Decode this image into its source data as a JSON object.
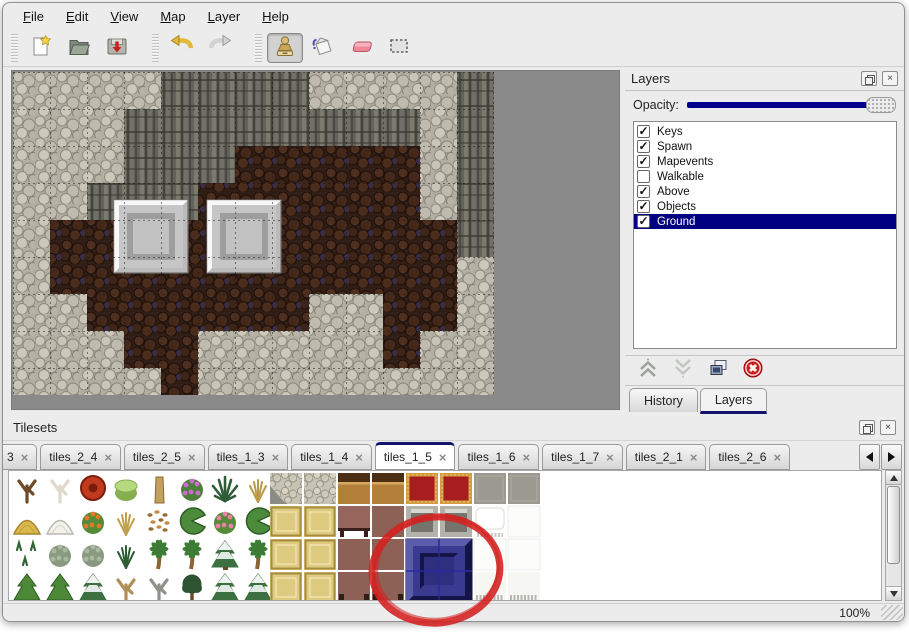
{
  "menu": {
    "items": [
      "File",
      "Edit",
      "View",
      "Map",
      "Layer",
      "Help"
    ]
  },
  "toolbar": {
    "groups": [
      {
        "buttons": [
          {
            "name": "new-file",
            "icon": "new"
          },
          {
            "name": "open-file",
            "icon": "open"
          },
          {
            "name": "save-file",
            "icon": "save"
          }
        ]
      },
      {
        "buttons": [
          {
            "name": "undo",
            "icon": "undo"
          },
          {
            "name": "redo",
            "icon": "redo"
          }
        ]
      },
      {
        "buttons": [
          {
            "name": "stamp-tool",
            "icon": "stamp",
            "active": true
          },
          {
            "name": "fill-tool",
            "icon": "fill"
          },
          {
            "name": "eraser-tool",
            "icon": "eraser"
          },
          {
            "name": "select-tool",
            "icon": "select"
          }
        ]
      }
    ]
  },
  "map": {
    "tile_size": 37,
    "grid": [
      "LLLLDDDDLLLLD",
      "LLLDDDDDDDDLD",
      "LLLDDDBBBBBLD",
      "LLDDDBBBBBBLD",
      "LBBBBBBBBBBBD",
      "LBBBBBBBBBBBL",
      "LLBBBBBBLLBBL",
      "LLLBBLLLLLBLL",
      "LLLLBLLLLLLLL"
    ],
    "blocks": [
      {
        "x": 101,
        "y": 128,
        "w": 74,
        "h": 73
      },
      {
        "x": 194,
        "y": 128,
        "w": 74,
        "h": 73
      }
    ],
    "backdrop": "#8a8a8a",
    "palette": {
      "light": {
        "base": "#b2afa2",
        "shades": [
          "#c9c6b9",
          "#bfbcaf",
          "#ccc9bc",
          "#b7b4a7"
        ],
        "lines": [
          "#8f8c7f",
          "#87847a",
          "#827f73"
        ]
      },
      "dark": {
        "base": "#63625a",
        "ribs": [
          "#7b7a6e",
          "#45443c",
          "#717066",
          "#4b4a42"
        ],
        "breaks": "#3a392f"
      },
      "brown": {
        "base": "#311e16",
        "shades": [
          "#4e2f1f",
          "#44281a",
          "#3e2517",
          "#4a2c1d"
        ],
        "line": "#1c0f08",
        "fleck": "#3a3350"
      },
      "grid": "#141414",
      "block": [
        "#f0f0f0",
        "#c6c6c6",
        "#9e9e9e",
        "#c2c2c2"
      ]
    }
  },
  "layers_panel": {
    "title": "Layers",
    "opacity_label": "Opacity:",
    "slider_color": "#00008c",
    "selection_color": "#000080",
    "layers": [
      {
        "name": "Keys",
        "checked": true,
        "selected": false
      },
      {
        "name": "Spawn",
        "checked": true,
        "selected": false
      },
      {
        "name": "Mapevents",
        "checked": true,
        "selected": false
      },
      {
        "name": "Walkable",
        "checked": false,
        "selected": false
      },
      {
        "name": "Above",
        "checked": true,
        "selected": false
      },
      {
        "name": "Objects",
        "checked": true,
        "selected": false
      },
      {
        "name": "Ground",
        "checked": true,
        "selected": true
      }
    ],
    "actions": [
      {
        "name": "move-layer-up",
        "icon": "chevrons-up"
      },
      {
        "name": "move-layer-down",
        "icon": "chevrons-down"
      },
      {
        "name": "duplicate-layer",
        "icon": "copy"
      },
      {
        "name": "delete-layer",
        "icon": "delete"
      }
    ],
    "tabs": [
      {
        "label": "History",
        "active": false
      },
      {
        "label": "Layers",
        "active": true
      }
    ]
  },
  "tilesets_panel": {
    "title": "Tilesets",
    "tabs": [
      {
        "label": "3"
      },
      {
        "label": "tiles_2_4"
      },
      {
        "label": "tiles_2_5"
      },
      {
        "label": "tiles_1_3"
      },
      {
        "label": "tiles_1_4"
      },
      {
        "label": "tiles_1_5",
        "active": true
      },
      {
        "label": "tiles_1_6"
      },
      {
        "label": "tiles_1_7"
      },
      {
        "label": "tiles_2_1"
      },
      {
        "label": "tiles_2_6"
      }
    ],
    "plants": {
      "cell": 33,
      "origin_x": 2,
      "origin_y": 1,
      "grid": [
        [
          "treeBrown",
          "treeWhite",
          "flowerRed",
          "stump",
          "trunk",
          "bushPurple",
          "fernDark",
          "sprigTan"
        ],
        [
          "moundYellow",
          "moundWhite",
          "bushOrange",
          "tuftTan",
          "leaves",
          "lilypad",
          "bushPink",
          "lilypad"
        ],
        [
          "sprouts",
          "bushGray",
          "bushGray",
          "tuftGreen",
          "palm",
          "palm",
          "coniferSnow",
          "palm"
        ],
        [
          "conifer",
          "conifer",
          "coniferSnow",
          "treeTwist",
          "treeGray",
          "treeDark",
          "coniferSnow",
          "coniferSnow"
        ]
      ],
      "defs": {
        "treeBrown": {
          "shape": "tree",
          "c": [
            "#6e4a28"
          ]
        },
        "treeWhite": {
          "shape": "tree",
          "c": [
            "#ded9cc"
          ]
        },
        "flowerRed": {
          "shape": "flower",
          "c": [
            "#c03a20",
            "#7c1d0c"
          ]
        },
        "stump": {
          "shape": "stump",
          "c": [
            "#86b050",
            "#b5d97c"
          ]
        },
        "trunk": {
          "shape": "trunk",
          "c": [
            "#c2a05e",
            "#8a6a34"
          ]
        },
        "bushPurple": {
          "shape": "bush",
          "c": [
            "#4c8038",
            "#cf6ad4"
          ]
        },
        "fernDark": {
          "shape": "fern",
          "c": [
            "#2c5c38"
          ]
        },
        "sprigTan": {
          "shape": "tuft",
          "c": [
            "#b89a48"
          ]
        },
        "moundYellow": {
          "shape": "mound",
          "c": [
            "#d9b94e",
            "#a8862e"
          ]
        },
        "moundWhite": {
          "shape": "mound",
          "c": [
            "#f2f1ea",
            "#b9b9b0"
          ]
        },
        "bushOrange": {
          "shape": "bush",
          "c": [
            "#558a38",
            "#e07c28"
          ]
        },
        "tuftTan": {
          "shape": "tuft",
          "c": [
            "#c0a050"
          ]
        },
        "leaves": {
          "shape": "dots",
          "c": [
            "#9a6a30",
            "#c08a40"
          ]
        },
        "lilypad": {
          "shape": "pad",
          "c": [
            "#4c8a3c",
            "#2e5c24"
          ]
        },
        "bushPink": {
          "shape": "bush",
          "c": [
            "#558a38",
            "#e882a8"
          ]
        },
        "sprouts": {
          "shape": "sprouts",
          "c": [
            "#2e6434"
          ]
        },
        "bushGray": {
          "shape": "bush",
          "c": [
            "#8a9a82",
            "#aab8a0"
          ]
        },
        "tuftGreen": {
          "shape": "tuft",
          "c": [
            "#2e5c34"
          ]
        },
        "palm": {
          "shape": "palm",
          "c": [
            "#3c7c34",
            "#8a6434"
          ]
        },
        "coniferSnow": {
          "shape": "coniferSnow",
          "c": [
            "#3c7040",
            "#eef2f0",
            "#6a4a2a"
          ]
        },
        "conifer": {
          "shape": "conifer",
          "c": [
            "#4c8838",
            "#2e5c24",
            "#6a4a2a"
          ]
        },
        "treeTwist": {
          "shape": "tree",
          "c": [
            "#b09058"
          ]
        },
        "treeGray": {
          "shape": "tree",
          "c": [
            "#90908a"
          ]
        },
        "treeDark": {
          "shape": "bushTree",
          "c": [
            "#2e5434",
            "#6a4a2a"
          ]
        }
      }
    },
    "tiles": {
      "cell_w": 34,
      "cell_h": 33,
      "origin_x": 260,
      "origin_y": 1,
      "cells": [
        {
          "c": 0,
          "r": 0,
          "kind": "stoneCorner"
        },
        {
          "c": 1,
          "r": 0,
          "kind": "stone"
        },
        {
          "c": 2,
          "r": 0,
          "kind": "woodTop"
        },
        {
          "c": 3,
          "r": 0,
          "kind": "woodTop"
        },
        {
          "c": 4,
          "r": 0,
          "kind": "carpet"
        },
        {
          "c": 5,
          "r": 0,
          "kind": "carpet"
        },
        {
          "c": 6,
          "r": 0,
          "kind": "grayTile"
        },
        {
          "c": 7,
          "r": 0,
          "kind": "grayTile"
        },
        {
          "c": 0,
          "r": 1,
          "kind": "tanTile"
        },
        {
          "c": 1,
          "r": 1,
          "kind": "tanTile"
        },
        {
          "c": 2,
          "r": 1,
          "kind": "stool"
        },
        {
          "c": 3,
          "r": 1,
          "kind": "brownPlain"
        },
        {
          "c": 4,
          "r": 1,
          "kind": "alcove"
        },
        {
          "c": 5,
          "r": 1,
          "kind": "alcove"
        },
        {
          "c": 6,
          "r": 1,
          "kind": "pillow"
        },
        {
          "c": 7,
          "r": 1,
          "kind": "whitePlain"
        },
        {
          "c": 0,
          "r": 2,
          "kind": "tanTile"
        },
        {
          "c": 1,
          "r": 2,
          "kind": "tanTile"
        },
        {
          "c": 2,
          "r": 2,
          "kind": "brownPlain"
        },
        {
          "c": 3,
          "r": 2,
          "kind": "brownPlain"
        },
        {
          "c": 4,
          "r": 2,
          "kind": "blueSel",
          "cs": 2,
          "rs": 2
        },
        {
          "c": 6,
          "r": 2,
          "kind": "whitePlain"
        },
        {
          "c": 7,
          "r": 2,
          "kind": "whitePlain"
        },
        {
          "c": 0,
          "r": 3,
          "kind": "tanTile"
        },
        {
          "c": 1,
          "r": 3,
          "kind": "tanTile"
        },
        {
          "c": 2,
          "r": 3,
          "kind": "brownLegs"
        },
        {
          "c": 3,
          "r": 3,
          "kind": "brownLegs"
        },
        {
          "c": 6,
          "r": 3,
          "kind": "fringe"
        },
        {
          "c": 7,
          "r": 3,
          "kind": "fringe"
        }
      ],
      "defs": {
        "stone": {
          "c": [
            "#c6c3b4"
          ]
        },
        "stoneCorner": {
          "c": [
            "#c6c3b4",
            "#8c8c86"
          ]
        },
        "woodTop": {
          "c": [
            "#b28038",
            "#4c2e12",
            "#d9a860"
          ]
        },
        "carpet": {
          "c": [
            "#d29a3c",
            "#a81e1e",
            "#e8c87a"
          ]
        },
        "grayTile": {
          "c": [
            "#9c9a90",
            "#b0aea4"
          ]
        },
        "tanTile": {
          "c": [
            "#decb80",
            "#a88c3e",
            "#efe2ad"
          ]
        },
        "stool": {
          "c": [
            "#96655c",
            "#3a2018"
          ]
        },
        "brownPlain": {
          "c": [
            "#8e6156"
          ]
        },
        "brownLegs": {
          "c": [
            "#8e6156",
            "#331c14"
          ]
        },
        "alcove": {
          "c": [
            "#b2b2aa",
            "#74746c",
            "#d8d8d2"
          ]
        },
        "pillow": {
          "c": [
            "#fcfcfa",
            "#ffffff",
            "#c8c8c0"
          ]
        },
        "whitePlain": {
          "c": [
            "#fcfcfa"
          ]
        },
        "fringe": {
          "c": [
            "#f6f6f2",
            "#b8b8b0"
          ]
        },
        "blueSel": {
          "c": [
            "#2d2d7c",
            "#5c5cac",
            "#141446",
            "#3a3a90",
            "#2f2f80"
          ],
          "highlight": "#2a2aa0"
        }
      }
    }
  },
  "annotation": {
    "shape": "ellipse",
    "cx": 436,
    "cy": 570,
    "rx": 64,
    "ry": 53,
    "color": "#d42020",
    "width": 7
  },
  "statusbar": {
    "zoom": "100%"
  }
}
